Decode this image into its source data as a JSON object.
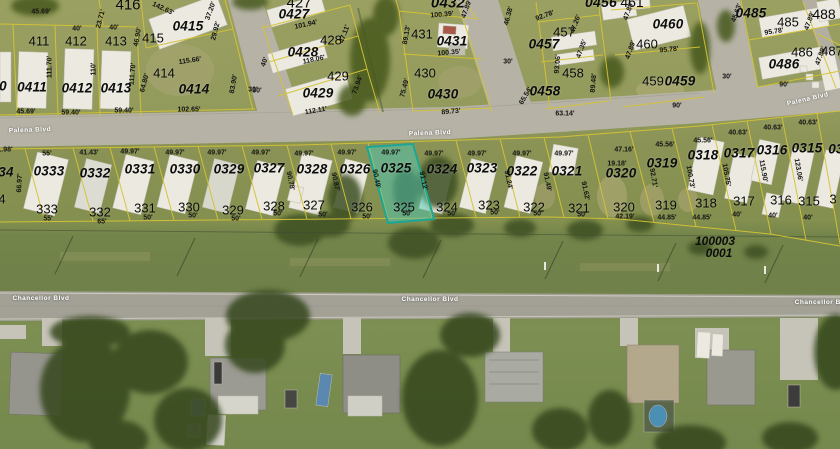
{
  "map": {
    "streets": [
      "Palena Blvd",
      "Chancellor Blvd"
    ],
    "selected_parcel": {
      "lot_id": "0325",
      "house_number": "325",
      "front_dim": "49.97'",
      "rear_dim": "50'",
      "side_dim": "90.49'"
    },
    "plss_label": {
      "line1": "100003",
      "line2": "0001"
    },
    "colors": {
      "highlight_fill": "#4ec7b7",
      "highlight_border": "#1ba695",
      "parcel_line": "#d4c335",
      "road": "#b6b3a6",
      "grass": "#7e8c51"
    }
  },
  "map_labels": [
    {
      "t": "416",
      "x": 128,
      "y": 5,
      "c": "num",
      "fs": 15
    },
    {
      "t": "0415",
      "x": 188,
      "y": 26,
      "c": "lotid"
    },
    {
      "t": "415",
      "x": 153,
      "y": 38,
      "c": "num"
    },
    {
      "t": "411",
      "x": 39,
      "y": 41,
      "c": "num"
    },
    {
      "t": "412",
      "x": 76,
      "y": 41,
      "c": "num"
    },
    {
      "t": "413",
      "x": 116,
      "y": 41,
      "c": "num"
    },
    {
      "t": "414",
      "x": 164,
      "y": 73,
      "c": "num"
    },
    {
      "t": "0411",
      "x": 32,
      "y": 87,
      "c": "lotid"
    },
    {
      "t": "0412",
      "x": 77,
      "y": 88,
      "c": "lotid"
    },
    {
      "t": "0413",
      "x": 116,
      "y": 88,
      "c": "lotid"
    },
    {
      "t": "0414",
      "x": 194,
      "y": 89,
      "c": "lotid"
    },
    {
      "t": "0",
      "x": 3,
      "y": 86,
      "c": "lotid"
    },
    {
      "t": "45.69'",
      "x": 41,
      "y": 12,
      "c": "dim"
    },
    {
      "t": "40'",
      "x": 77,
      "y": 29,
      "c": "dim"
    },
    {
      "t": "40'",
      "x": 114,
      "y": 28,
      "c": "dim"
    },
    {
      "t": "23.71'",
      "x": 101,
      "y": 19,
      "c": "dim",
      "r": -75
    },
    {
      "t": "142.63'",
      "x": 163,
      "y": 9,
      "c": "dim",
      "r": 25
    },
    {
      "t": "46.90'",
      "x": 138,
      "y": 37,
      "c": "dim",
      "r": -80
    },
    {
      "t": "37.20'",
      "x": 211,
      "y": 11,
      "c": "dim",
      "r": -70
    },
    {
      "t": "29.92'",
      "x": 216,
      "y": 31,
      "c": "dim",
      "r": -75
    },
    {
      "t": "111.70'",
      "x": 50,
      "y": 67,
      "c": "dim",
      "r": -90
    },
    {
      "t": "110'",
      "x": 94,
      "y": 69,
      "c": "dim",
      "r": -90
    },
    {
      "t": "111.70'",
      "x": 133,
      "y": 74,
      "c": "dim",
      "r": -85
    },
    {
      "t": "64.80'",
      "x": 145,
      "y": 83,
      "c": "dim",
      "r": -75
    },
    {
      "t": "115.66'",
      "x": 190,
      "y": 61,
      "c": "dim",
      "r": -8
    },
    {
      "t": "83.90'",
      "x": 234,
      "y": 84,
      "c": "dim",
      "r": -80
    },
    {
      "t": "30'",
      "x": 253,
      "y": 90,
      "c": "dim"
    },
    {
      "t": "45.69'",
      "x": 26,
      "y": 112,
      "c": "dim"
    },
    {
      "t": "59.40'",
      "x": 71,
      "y": 113,
      "c": "dim"
    },
    {
      "t": "59.40'",
      "x": 124,
      "y": 111,
      "c": "dim"
    },
    {
      "t": "102.65'",
      "x": 189,
      "y": 110,
      "c": "dim"
    },
    {
      "t": "427",
      "x": 299,
      "y": 3,
      "c": "num",
      "fs": 15
    },
    {
      "t": "0427",
      "x": 294,
      "y": 14,
      "c": "lotid"
    },
    {
      "t": "101.94'",
      "x": 306,
      "y": 25,
      "c": "dim",
      "r": -12
    },
    {
      "t": "428",
      "x": 331,
      "y": 40,
      "c": "num"
    },
    {
      "t": "0428",
      "x": 303,
      "y": 52,
      "c": "lotid"
    },
    {
      "t": "118.06'",
      "x": 314,
      "y": 60,
      "c": "dim",
      "r": -12
    },
    {
      "t": "429",
      "x": 338,
      "y": 76,
      "c": "num"
    },
    {
      "t": "0429",
      "x": 318,
      "y": 93,
      "c": "lotid"
    },
    {
      "t": "112.11'",
      "x": 316,
      "y": 111,
      "c": "dim",
      "r": -10
    },
    {
      "t": "40'",
      "x": 265,
      "y": 62,
      "c": "dim",
      "r": -70
    },
    {
      "t": "30'",
      "x": 257,
      "y": 91,
      "c": "dim"
    },
    {
      "t": "47.11'",
      "x": 345,
      "y": 34,
      "c": "dim",
      "r": -70
    },
    {
      "t": "73.94'",
      "x": 358,
      "y": 85,
      "c": "dim",
      "r": -70
    },
    {
      "t": "431",
      "x": 422,
      "y": 34,
      "c": "num"
    },
    {
      "t": "0431",
      "x": 452,
      "y": 41,
      "c": "lotid"
    },
    {
      "t": "100.39'",
      "x": 442,
      "y": 15,
      "c": "dim",
      "r": -5
    },
    {
      "t": "100.35'",
      "x": 449,
      "y": 53,
      "c": "dim",
      "r": -5
    },
    {
      "t": "430",
      "x": 425,
      "y": 73,
      "c": "num"
    },
    {
      "t": "0430",
      "x": 443,
      "y": 94,
      "c": "lotid"
    },
    {
      "t": "89.73'",
      "x": 451,
      "y": 112,
      "c": "dim",
      "r": -5
    },
    {
      "t": "75.49'",
      "x": 405,
      "y": 88,
      "c": "dim",
      "r": -75
    },
    {
      "t": "89.13'",
      "x": 407,
      "y": 35,
      "c": "dim",
      "r": -80
    },
    {
      "t": "0432",
      "x": 448,
      "y": 3,
      "c": "lotid",
      "fs": 15
    },
    {
      "t": "47.89'",
      "x": 467,
      "y": 9,
      "c": "dim",
      "r": -70
    },
    {
      "t": "46.38'",
      "x": 509,
      "y": 16,
      "c": "dim",
      "r": -75
    },
    {
      "t": "65.54'",
      "x": 526,
      "y": 96,
      "c": "dim",
      "r": -60
    },
    {
      "t": "30'",
      "x": 508,
      "y": 62,
      "c": "dim"
    },
    {
      "t": "0456",
      "x": 601,
      "y": 2,
      "c": "lotid",
      "fs": 14
    },
    {
      "t": "92.78'",
      "x": 545,
      "y": 16,
      "c": "dim",
      "r": -20
    },
    {
      "t": "457",
      "x": 564,
      "y": 32,
      "c": "num"
    },
    {
      "t": "0457",
      "x": 544,
      "y": 44,
      "c": "lotid"
    },
    {
      "t": "47.26'",
      "x": 576,
      "y": 24,
      "c": "dim",
      "r": -70
    },
    {
      "t": "47.35'",
      "x": 582,
      "y": 49,
      "c": "dim",
      "r": -70
    },
    {
      "t": "458",
      "x": 573,
      "y": 73,
      "c": "num"
    },
    {
      "t": "0458",
      "x": 545,
      "y": 91,
      "c": "lotid"
    },
    {
      "t": "93.06'",
      "x": 558,
      "y": 64,
      "c": "dim",
      "r": -85
    },
    {
      "t": "89.48'",
      "x": 594,
      "y": 83,
      "c": "dim",
      "r": -85
    },
    {
      "t": "63.14'",
      "x": 565,
      "y": 114,
      "c": "dim"
    },
    {
      "t": "461",
      "x": 632,
      "y": 2,
      "c": "num",
      "fs": 14
    },
    {
      "t": "47.89'",
      "x": 629,
      "y": 11,
      "c": "dim",
      "r": -70
    },
    {
      "t": "0460",
      "x": 668,
      "y": 24,
      "c": "lotid"
    },
    {
      "t": "460",
      "x": 647,
      "y": 44,
      "c": "num"
    },
    {
      "t": "95.78'",
      "x": 669,
      "y": 50,
      "c": "dim",
      "r": -5
    },
    {
      "t": "47.89'",
      "x": 631,
      "y": 50,
      "c": "dim",
      "r": -70
    },
    {
      "t": "459",
      "x": 653,
      "y": 81,
      "c": "num"
    },
    {
      "t": "0459",
      "x": 680,
      "y": 81,
      "c": "lotid"
    },
    {
      "t": "90'",
      "x": 677,
      "y": 106,
      "c": "dim"
    },
    {
      "t": "30'",
      "x": 727,
      "y": 77,
      "c": "dim"
    },
    {
      "t": "0485",
      "x": 751,
      "y": 13,
      "c": "lotid"
    },
    {
      "t": "45.63'",
      "x": 737,
      "y": 13,
      "c": "dim",
      "r": -70
    },
    {
      "t": "485",
      "x": 788,
      "y": 22,
      "c": "num"
    },
    {
      "t": "488",
      "x": 824,
      "y": 14,
      "c": "num",
      "fs": 14
    },
    {
      "t": "95.78'",
      "x": 774,
      "y": 32,
      "c": "dim",
      "r": -8
    },
    {
      "t": "47.89'",
      "x": 810,
      "y": 21,
      "c": "dim",
      "r": -70
    },
    {
      "t": "486",
      "x": 802,
      "y": 52,
      "c": "num"
    },
    {
      "t": "0486",
      "x": 784,
      "y": 64,
      "c": "lotid"
    },
    {
      "t": "487",
      "x": 832,
      "y": 51,
      "c": "num"
    },
    {
      "t": "47.89'",
      "x": 821,
      "y": 56,
      "c": "dim",
      "r": -70
    },
    {
      "t": "90'",
      "x": 784,
      "y": 85,
      "c": "dim"
    },
    {
      "t": "Palena Blvd",
      "x": 30,
      "y": 131,
      "c": "street",
      "r": -2
    },
    {
      "t": "Palena Blvd",
      "x": 430,
      "y": 134,
      "c": "street",
      "r": -2
    },
    {
      "t": "Palena Blvd",
      "x": 808,
      "y": 100,
      "c": "street",
      "r": -13
    },
    {
      "t": "Chancellor Blvd",
      "x": 41,
      "y": 299,
      "c": "street"
    },
    {
      "t": "Chancellor Blvd",
      "x": 430,
      "y": 300,
      "c": "street"
    },
    {
      "t": "Chancellor Blv",
      "x": 821,
      "y": 303,
      "c": "street"
    },
    {
      "t": "100003",
      "x": 715,
      "y": 241,
      "c": "plss"
    },
    {
      "t": "0001",
      "x": 719,
      "y": 253,
      "c": "plss"
    },
    {
      "t": "34",
      "x": 6,
      "y": 172,
      "c": "lotid"
    },
    {
      "t": "0333",
      "x": 49,
      "y": 171,
      "c": "lotid"
    },
    {
      "t": "0332",
      "x": 95,
      "y": 173,
      "c": "lotid"
    },
    {
      "t": "0331",
      "x": 140,
      "y": 169,
      "c": "lotid"
    },
    {
      "t": "0330",
      "x": 185,
      "y": 169,
      "c": "lotid"
    },
    {
      "t": "0329",
      "x": 229,
      "y": 169,
      "c": "lotid"
    },
    {
      "t": "0327",
      "x": 269,
      "y": 168,
      "c": "lotid"
    },
    {
      "t": "0328",
      "x": 312,
      "y": 169,
      "c": "lotid"
    },
    {
      "t": "0326",
      "x": 355,
      "y": 169,
      "c": "lotid"
    },
    {
      "t": "0325",
      "x": 396,
      "y": 168,
      "c": "lotid"
    },
    {
      "t": "0324",
      "x": 442,
      "y": 169,
      "c": "lotid"
    },
    {
      "t": "0323",
      "x": 482,
      "y": 168,
      "c": "lotid"
    },
    {
      "t": "0322",
      "x": 522,
      "y": 171,
      "c": "lotid"
    },
    {
      "t": "0321",
      "x": 567,
      "y": 171,
      "c": "lotid"
    },
    {
      "t": "0320",
      "x": 621,
      "y": 173,
      "c": "lotid"
    },
    {
      "t": "0319",
      "x": 662,
      "y": 163,
      "c": "lotid"
    },
    {
      "t": "0318",
      "x": 703,
      "y": 155,
      "c": "lotid"
    },
    {
      "t": "0317",
      "x": 739,
      "y": 153,
      "c": "lotid"
    },
    {
      "t": "0316",
      "x": 772,
      "y": 150,
      "c": "lotid"
    },
    {
      "t": "0315",
      "x": 807,
      "y": 148,
      "c": "lotid"
    },
    {
      "t": "03",
      "x": 836,
      "y": 149,
      "c": "lotid"
    },
    {
      "t": "55'",
      "x": 47,
      "y": 154,
      "c": "dim"
    },
    {
      "t": "41.43'",
      "x": 89,
      "y": 153,
      "c": "dim"
    },
    {
      "t": "49.97'",
      "x": 130,
      "y": 152,
      "c": "dim"
    },
    {
      "t": "49.97'",
      "x": 175,
      "y": 153,
      "c": "dim"
    },
    {
      "t": "49.97'",
      "x": 217,
      "y": 153,
      "c": "dim"
    },
    {
      "t": "49.97'",
      "x": 261,
      "y": 153,
      "c": "dim"
    },
    {
      "t": "49.97'",
      "x": 304,
      "y": 154,
      "c": "dim"
    },
    {
      "t": "49.97'",
      "x": 347,
      "y": 153,
      "c": "dim"
    },
    {
      "t": "49.97'",
      "x": 391,
      "y": 153,
      "c": "dim"
    },
    {
      "t": "49.97'",
      "x": 434,
      "y": 154,
      "c": "dim"
    },
    {
      "t": "49.97'",
      "x": 477,
      "y": 154,
      "c": "dim"
    },
    {
      "t": "49.97'",
      "x": 522,
      "y": 154,
      "c": "dim"
    },
    {
      "t": "49.97'",
      "x": 564,
      "y": 154,
      "c": "dim"
    },
    {
      "t": "47.16'",
      "x": 624,
      "y": 150,
      "c": "dim"
    },
    {
      "t": "19.18'",
      "x": 617,
      "y": 164,
      "c": "dim"
    },
    {
      "t": "45.56'",
      "x": 665,
      "y": 145,
      "c": "dim"
    },
    {
      "t": "45.56'",
      "x": 703,
      "y": 141,
      "c": "dim"
    },
    {
      "t": "40.63'",
      "x": 738,
      "y": 133,
      "c": "dim"
    },
    {
      "t": "40.63'",
      "x": 773,
      "y": 128,
      "c": "dim"
    },
    {
      "t": "40.63'",
      "x": 808,
      "y": 123,
      "c": "dim"
    },
    {
      "t": "66.97'",
      "x": 20,
      "y": 183,
      "c": "dim",
      "r": -87
    },
    {
      "t": "90.78'",
      "x": 290,
      "y": 181,
      "c": "dim",
      "r": 78
    },
    {
      "t": "90.87'",
      "x": 335,
      "y": 182,
      "c": "dim",
      "r": 78
    },
    {
      "t": "90.49'",
      "x": 376,
      "y": 179,
      "c": "dim",
      "r": 78
    },
    {
      "t": "91.12'",
      "x": 423,
      "y": 181,
      "c": "dim",
      "r": 78
    },
    {
      "t": "91.24'",
      "x": 508,
      "y": 180,
      "c": "dim",
      "r": 78
    },
    {
      "t": "91.49'",
      "x": 547,
      "y": 182,
      "c": "dim",
      "r": 78
    },
    {
      "t": "91.62'",
      "x": 585,
      "y": 191,
      "c": "dim",
      "r": 78
    },
    {
      "t": "92.71'",
      "x": 653,
      "y": 178,
      "c": "dim",
      "r": 80
    },
    {
      "t": "100.73'",
      "x": 690,
      "y": 177,
      "c": "dim",
      "r": 80
    },
    {
      "t": "105.75'",
      "x": 726,
      "y": 175,
      "c": "dim",
      "r": 80
    },
    {
      "t": "115.90'",
      "x": 763,
      "y": 171,
      "c": "dim",
      "r": 80
    },
    {
      "t": "123.06'",
      "x": 798,
      "y": 170,
      "c": "dim",
      "r": 80
    },
    {
      "t": "4",
      "x": 2,
      "y": 199,
      "c": "num"
    },
    {
      "t": "333",
      "x": 47,
      "y": 209,
      "c": "num"
    },
    {
      "t": "332",
      "x": 100,
      "y": 212,
      "c": "num"
    },
    {
      "t": "331",
      "x": 145,
      "y": 208,
      "c": "num"
    },
    {
      "t": "330",
      "x": 189,
      "y": 207,
      "c": "num"
    },
    {
      "t": "329",
      "x": 233,
      "y": 210,
      "c": "num"
    },
    {
      "t": "328",
      "x": 274,
      "y": 206,
      "c": "num"
    },
    {
      "t": "327",
      "x": 314,
      "y": 205,
      "c": "num"
    },
    {
      "t": "326",
      "x": 362,
      "y": 207,
      "c": "num"
    },
    {
      "t": "325",
      "x": 404,
      "y": 207,
      "c": "num"
    },
    {
      "t": "324",
      "x": 447,
      "y": 207,
      "c": "num"
    },
    {
      "t": "323",
      "x": 489,
      "y": 205,
      "c": "num"
    },
    {
      "t": "322",
      "x": 534,
      "y": 207,
      "c": "num"
    },
    {
      "t": "321",
      "x": 579,
      "y": 208,
      "c": "num"
    },
    {
      "t": "320",
      "x": 624,
      "y": 207,
      "c": "num"
    },
    {
      "t": "319",
      "x": 666,
      "y": 205,
      "c": "num"
    },
    {
      "t": "318",
      "x": 706,
      "y": 203,
      "c": "num"
    },
    {
      "t": "317",
      "x": 744,
      "y": 201,
      "c": "num"
    },
    {
      "t": "316",
      "x": 781,
      "y": 200,
      "c": "num"
    },
    {
      "t": "315",
      "x": 809,
      "y": 201,
      "c": "num"
    },
    {
      "t": "3",
      "x": 833,
      "y": 199,
      "c": "num"
    },
    {
      "t": "55'",
      "x": 48,
      "y": 219,
      "c": "dim"
    },
    {
      "t": "65'",
      "x": 102,
      "y": 222,
      "c": "dim"
    },
    {
      "t": "50'",
      "x": 148,
      "y": 218,
      "c": "dim"
    },
    {
      "t": "50'",
      "x": 193,
      "y": 216,
      "c": "dim"
    },
    {
      "t": "50'",
      "x": 236,
      "y": 219,
      "c": "dim"
    },
    {
      "t": "50'",
      "x": 278,
      "y": 214,
      "c": "dim"
    },
    {
      "t": "50'",
      "x": 323,
      "y": 215,
      "c": "dim"
    },
    {
      "t": "50'",
      "x": 367,
      "y": 217,
      "c": "dim"
    },
    {
      "t": "50'",
      "x": 407,
      "y": 214,
      "c": "dim"
    },
    {
      "t": "50'",
      "x": 452,
      "y": 214,
      "c": "dim"
    },
    {
      "t": "50'",
      "x": 495,
      "y": 213,
      "c": "dim"
    },
    {
      "t": "50'",
      "x": 538,
      "y": 214,
      "c": "dim"
    },
    {
      "t": "50'",
      "x": 582,
      "y": 215,
      "c": "dim"
    },
    {
      "t": "42.19'",
      "x": 625,
      "y": 217,
      "c": "dim"
    },
    {
      "t": "44.85'",
      "x": 667,
      "y": 218,
      "c": "dim"
    },
    {
      "t": "44.85'",
      "x": 702,
      "y": 218,
      "c": "dim"
    },
    {
      "t": "40'",
      "x": 737,
      "y": 215,
      "c": "dim"
    },
    {
      "t": "40'",
      "x": 773,
      "y": 216,
      "c": "dim"
    },
    {
      "t": "40'",
      "x": 808,
      "y": 218,
      "c": "dim"
    },
    {
      "t": "1.98'",
      "x": 5,
      "y": 150,
      "c": "dim"
    }
  ]
}
